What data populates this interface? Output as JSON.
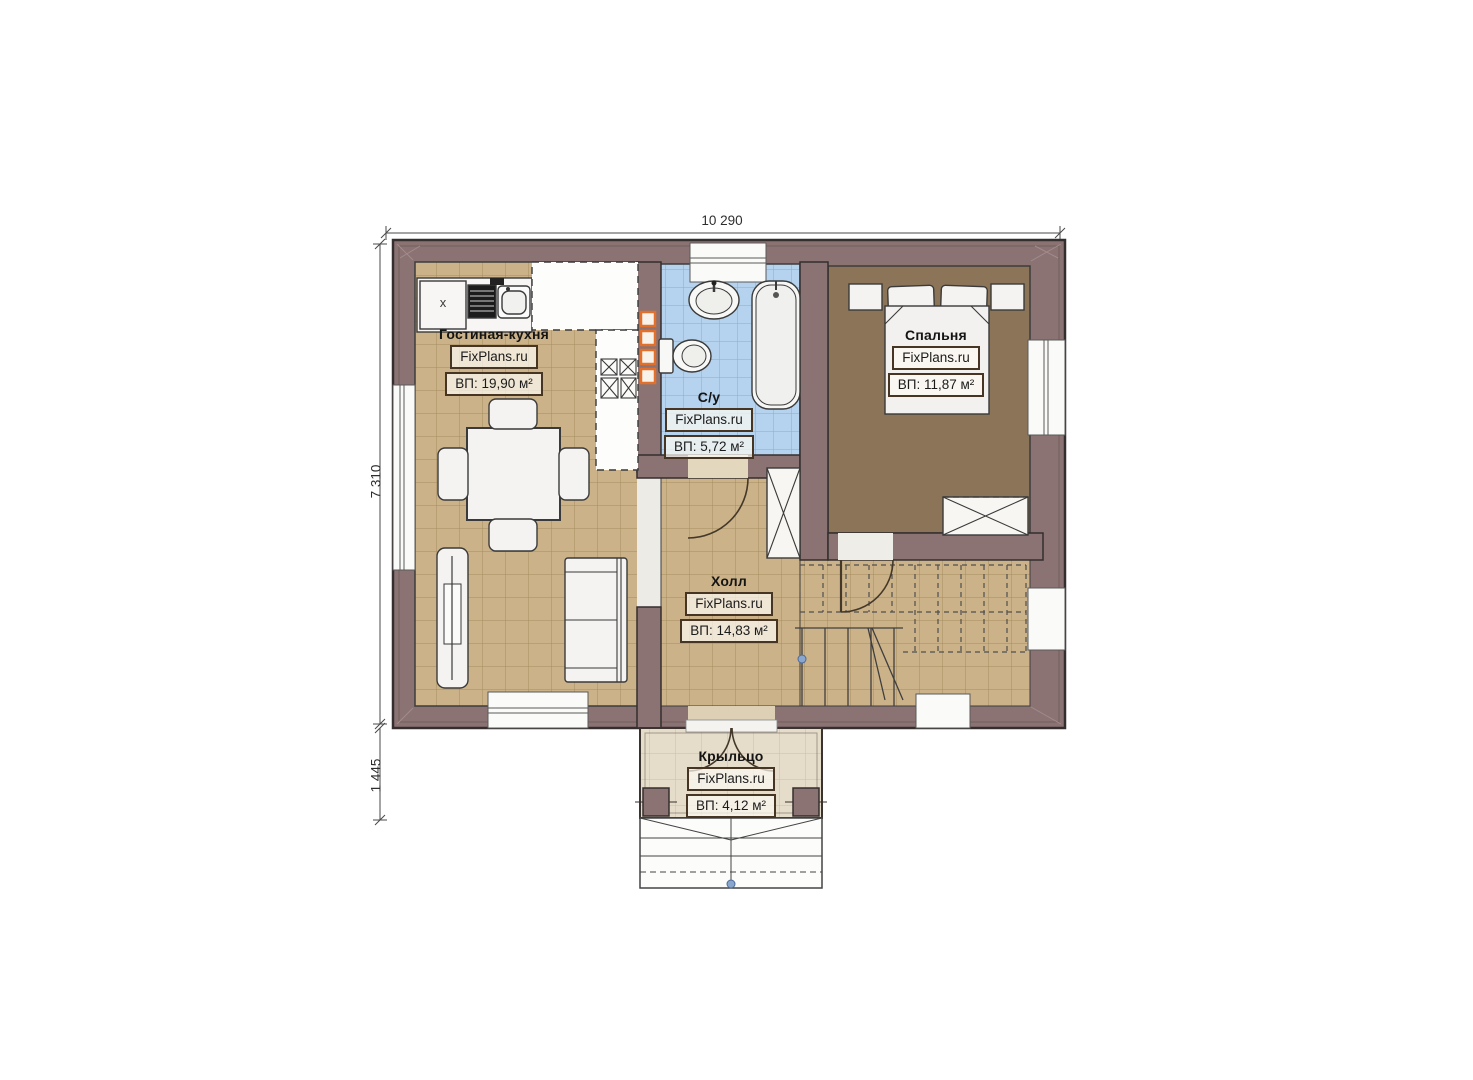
{
  "plan": {
    "source_brand": "FixPlans.ru",
    "floor_type": "first-floor plan"
  },
  "dimensions": {
    "top_width": "10 290",
    "left_height": "7 310",
    "porch_depth": "1 445"
  },
  "rooms": {
    "living_kitchen": {
      "title": "Гостиная-кухня",
      "brand": "FixPlans.ru",
      "area": "ВП: 19,90 м²"
    },
    "bathroom": {
      "title": "С/у",
      "brand": "FixPlans.ru",
      "area": "ВП: 5,72 м²"
    },
    "bedroom": {
      "title": "Спальня",
      "brand": "FixPlans.ru",
      "area": "ВП: 11,87 м²"
    },
    "hall": {
      "title": "Холл",
      "brand": "FixPlans.ru",
      "area": "ВП: 14,83 м²"
    },
    "porch": {
      "title": "Крыльцо",
      "brand": "FixPlans.ru",
      "area": "ВП: 4,12 м²"
    }
  },
  "kitchen": {
    "cabinet_label": "x"
  },
  "colors": {
    "wall": "#8c7373",
    "wall_outline": "#352e2e",
    "floor_tan": "#cbb288",
    "floor_tan_grid": "#a58c5f",
    "floor_blue": "#b5d2ee",
    "floor_blue_grid": "#86aed2",
    "floor_bedroom": "#8b7457",
    "floor_porch": "#e6dcca",
    "vent_orange": "#e2702a",
    "label_border": "#463523",
    "furniture_fill": "#f4f3f1",
    "dimension_line": "#4a4a4a"
  }
}
